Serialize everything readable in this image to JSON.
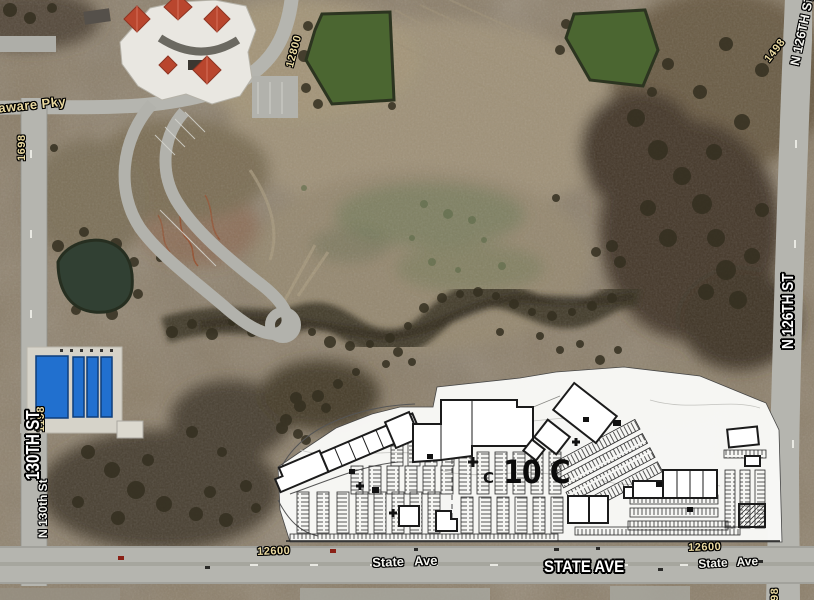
{
  "map": {
    "street_labels": {
      "delaware_pky": "Delaware Pky",
      "n_130th_st_big": "130TH ST",
      "n_130th_st_small": "N 130th St",
      "n_126th_st_big": "N 126TH ST",
      "n_126th_st_top_partial": "N 126TH ST",
      "state_ave_big": "STATE AVE",
      "state_ave_west": "State Ave",
      "state_ave_east": "State Ave"
    },
    "address_labels": {
      "west_1698": "1698",
      "west_1198": "1198",
      "north_12800": "12800",
      "east_1498": "1498",
      "south_12600_west": "12600",
      "south_12600_east": "12600",
      "southeast_partial": "98"
    },
    "site_plan": {
      "label_large": "10 C",
      "label_small": "C"
    },
    "colors": {
      "terrain_base": "#8a7c66",
      "woods_dark": "#43392a",
      "pond_green": "#4b6631",
      "road_gray": "#b5b5af",
      "plan_white": "#fafaf8",
      "roof_red": "#b9462e",
      "roof_blue": "#2170cf",
      "label_tan": "#ead9a0"
    }
  }
}
